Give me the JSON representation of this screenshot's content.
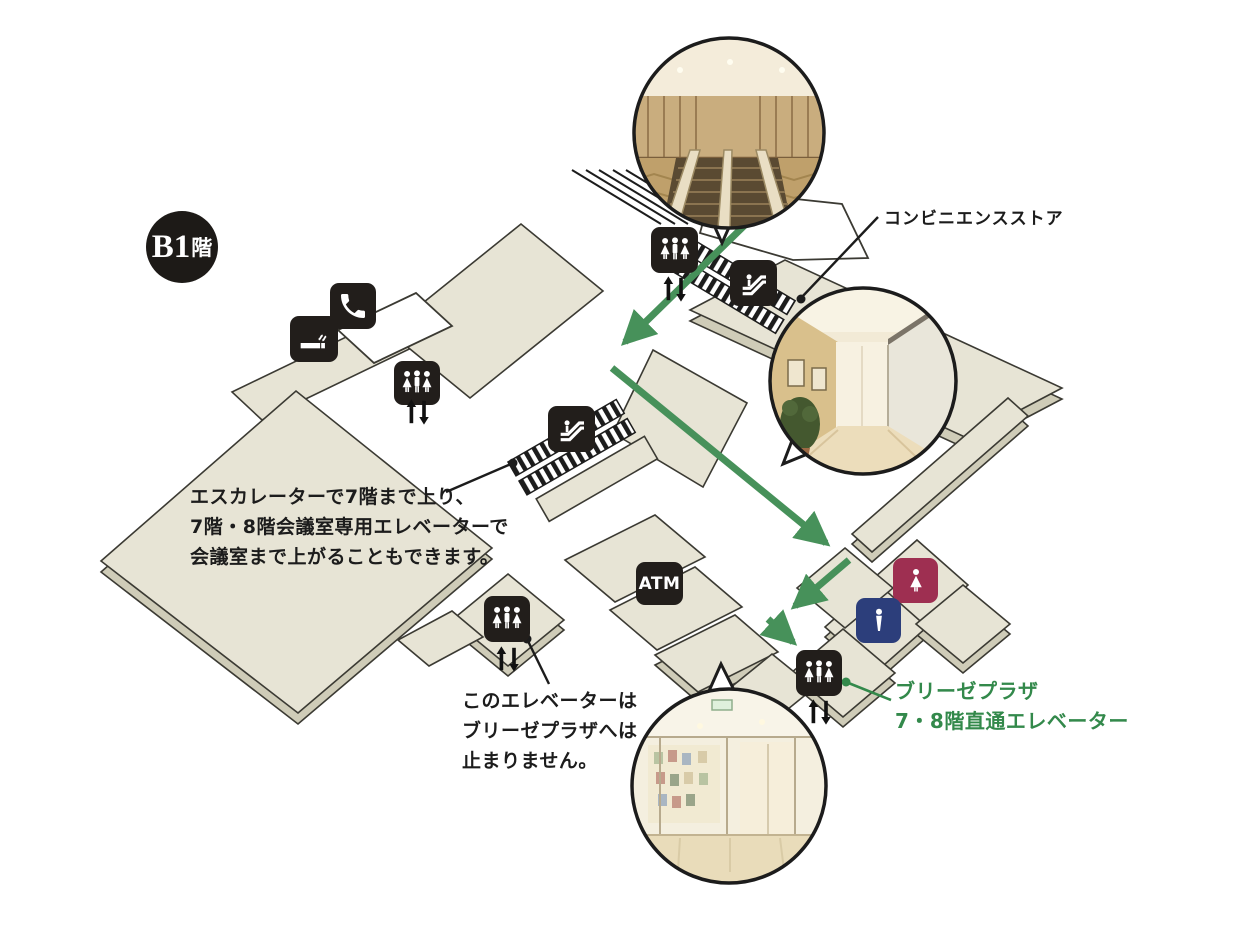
{
  "floor_badge": {
    "main": "B1",
    "suffix": "階",
    "full": "B1階"
  },
  "labels": {
    "convenience_store": "コンビニエンスストア",
    "escalator_note": [
      "エスカレーターで7階まで上り、",
      "7階・8階会議室専用エレベーターで",
      "会議室まで上がることもできます。"
    ],
    "elevator_note": [
      "このエレベーターは",
      "ブリーゼプラザへは",
      "止まりません。"
    ],
    "direct_elevator": [
      "ブリーゼプラザ",
      "7・8階直通エレベーター"
    ]
  },
  "icons": {
    "atm_label": "ATM",
    "names": [
      "phone-icon",
      "smoking-icon",
      "elevator-icon",
      "escalator-icon",
      "atm-icon",
      "restroom-women-icon",
      "restroom-men-icon",
      "up-down-arrows-icon"
    ]
  },
  "photos": [
    {
      "name": "escalator-lobby-photo"
    },
    {
      "name": "corridor-photo"
    },
    {
      "name": "glass-entrance-photo"
    }
  ],
  "colors": {
    "map_fill": "#e7e4d5",
    "map_side": "#cfccb8",
    "map_stroke": "#3b3a33",
    "route_green": "#47915a",
    "label_green": "#33894b",
    "tile_black": "#221e1b",
    "women_red": "#9e2f51",
    "men_navy": "#2c3e7b"
  }
}
